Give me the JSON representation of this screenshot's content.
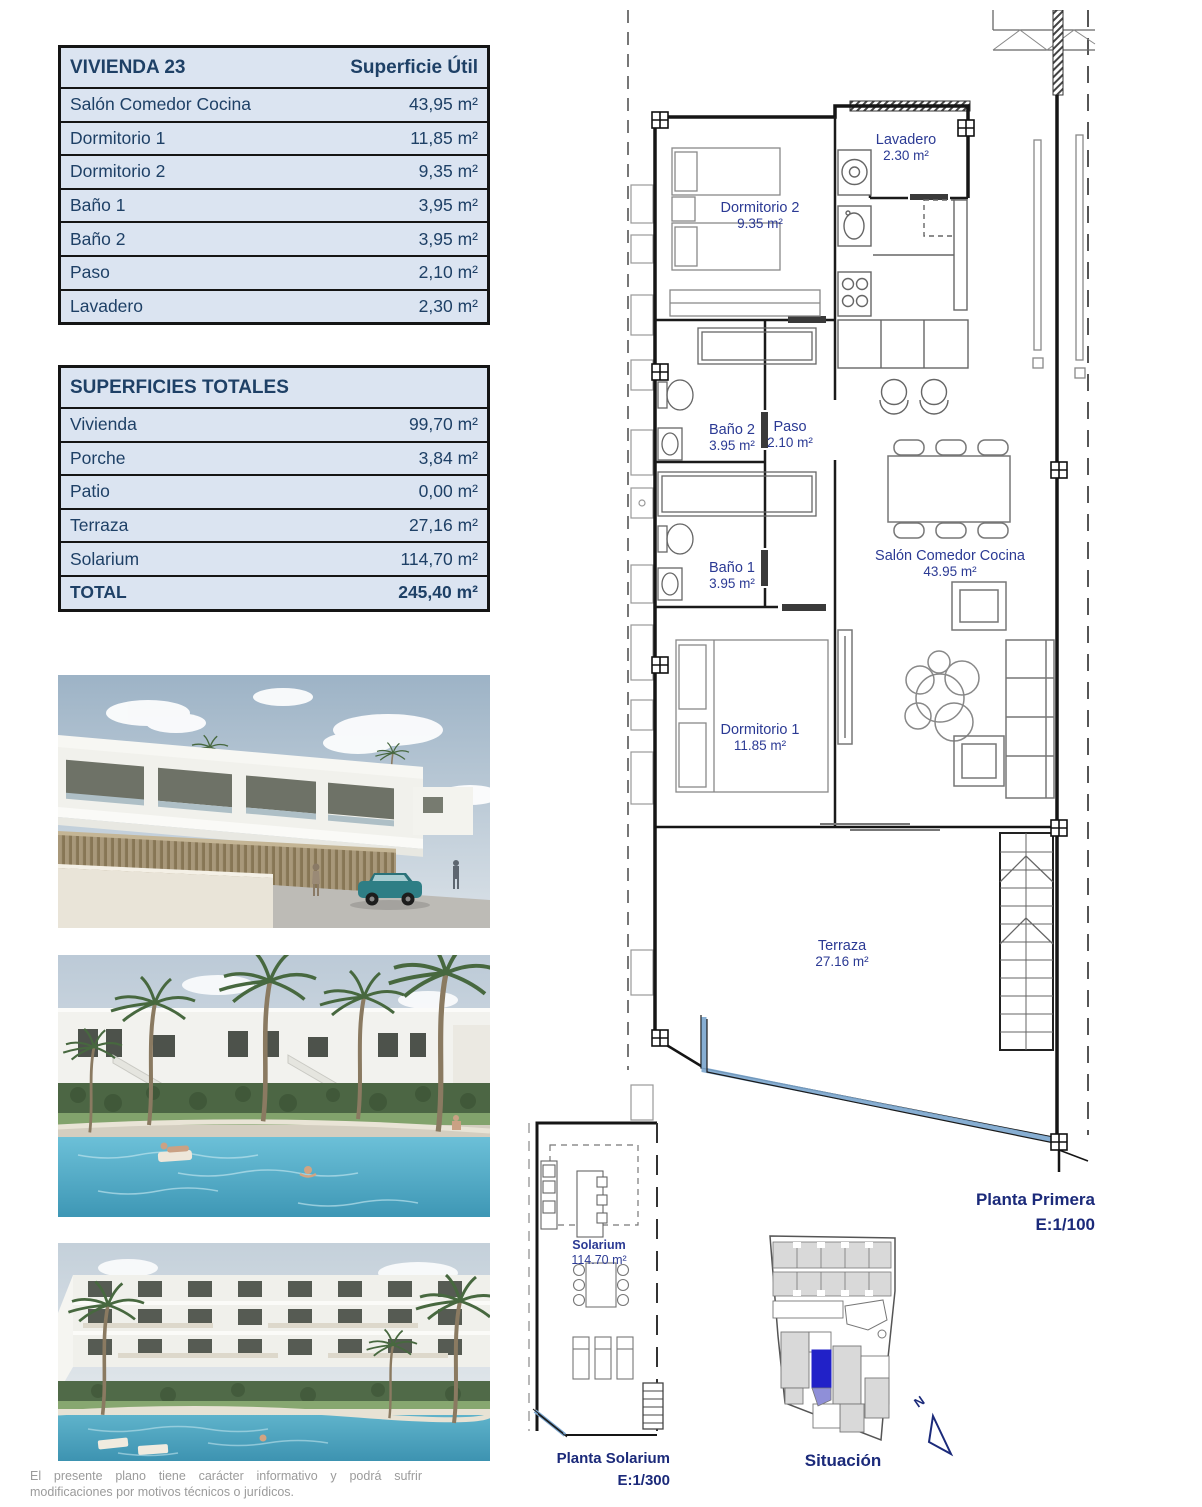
{
  "tables": {
    "vivienda": {
      "title": "VIVIENDA 23",
      "header_right": "Superficie Útil",
      "rows": [
        {
          "label": "Salón Comedor Cocina",
          "value": "43,95 m²"
        },
        {
          "label": "Dormitorio 1",
          "value": "11,85 m²"
        },
        {
          "label": "Dormitorio 2",
          "value": "9,35 m²"
        },
        {
          "label": "Baño 1",
          "value": "3,95 m²"
        },
        {
          "label": "Baño 2",
          "value": "3,95 m²"
        },
        {
          "label": "Paso",
          "value": "2,10 m²"
        },
        {
          "label": "Lavadero",
          "value": "2,30 m²"
        }
      ]
    },
    "totales": {
      "title": "SUPERFICIES TOTALES",
      "rows": [
        {
          "label": "Vivienda",
          "value": "99,70 m²"
        },
        {
          "label": "Porche",
          "value": "3,84 m²"
        },
        {
          "label": "Patio",
          "value": "0,00 m²"
        },
        {
          "label": "Terraza",
          "value": "27,16 m²"
        },
        {
          "label": "Solarium",
          "value": "114,70 m²"
        }
      ],
      "total": {
        "label": "TOTAL",
        "value": "245,40 m²"
      }
    }
  },
  "floorplan": {
    "rooms": [
      {
        "name": "Dormitorio 2",
        "area": "9.35 m²"
      },
      {
        "name": "Lavadero",
        "area": "2.30 m²"
      },
      {
        "name": "Baño 2",
        "area": "3.95 m²"
      },
      {
        "name": "Paso",
        "area": "2.10 m²"
      },
      {
        "name": "Baño 1",
        "area": "3.95 m²"
      },
      {
        "name": "Dormitorio 1",
        "area": "11.85 m²"
      },
      {
        "name": "Salón Comedor Cocina",
        "area": "43.95 m²"
      },
      {
        "name": "Terraza",
        "area": "27.16 m²"
      }
    ],
    "caption": {
      "title": "Planta Primera",
      "scale": "E:1/100"
    }
  },
  "solarium_plan": {
    "room": {
      "name": "Solarium",
      "area": "114.70 m²"
    },
    "caption": {
      "title": "Planta Solarium",
      "scale": "E:1/300"
    }
  },
  "situacion": {
    "caption": "Situación",
    "north_label": "N",
    "highlight_color": "#2121c8"
  },
  "disclaimer": "El presente plano tiene carácter informativo y podrá sufrir modificaciones por motivos técnicos o jurídicos.",
  "colors": {
    "table_background": "#dbe4f1",
    "table_text": "#1e4066",
    "plan_label_navy": "#2b3a94",
    "caption_navy": "#1b2a7a",
    "glass_balustrade_blue": "#7aa5cd",
    "site_highlight_blue": "#2121c8"
  }
}
